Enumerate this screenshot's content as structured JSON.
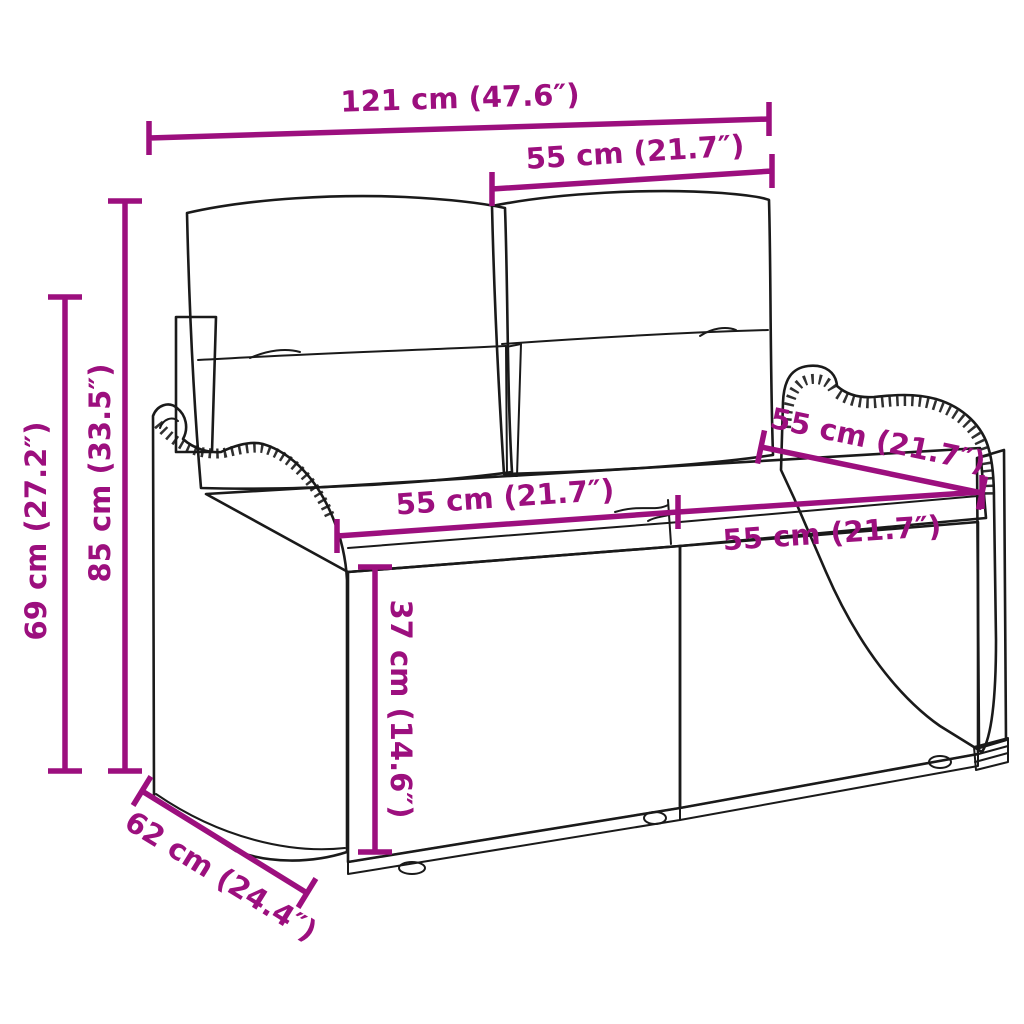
{
  "palette": {
    "dimension_color": "#9c0f7e",
    "drawing_line_color": "#1a1a1a",
    "background": "#ffffff"
  },
  "dimensions": {
    "overall_width": {
      "label": "121 cm (47.6″)"
    },
    "back_cushion_width": {
      "label": "55 cm (21.7″)"
    },
    "total_height": {
      "label": "85 cm (33.5″)"
    },
    "back_height": {
      "label": "69 cm (27.2″)"
    },
    "seat_left_width": {
      "label": "55 cm (21.7″)"
    },
    "seat_right_width": {
      "label": "55 cm (21.7″)"
    },
    "seat_depth": {
      "label": "55 cm (21.7″)"
    },
    "base_height": {
      "label": "37 cm (14.6″)"
    },
    "bottom_depth": {
      "label": "62 cm (24.4″)"
    }
  }
}
